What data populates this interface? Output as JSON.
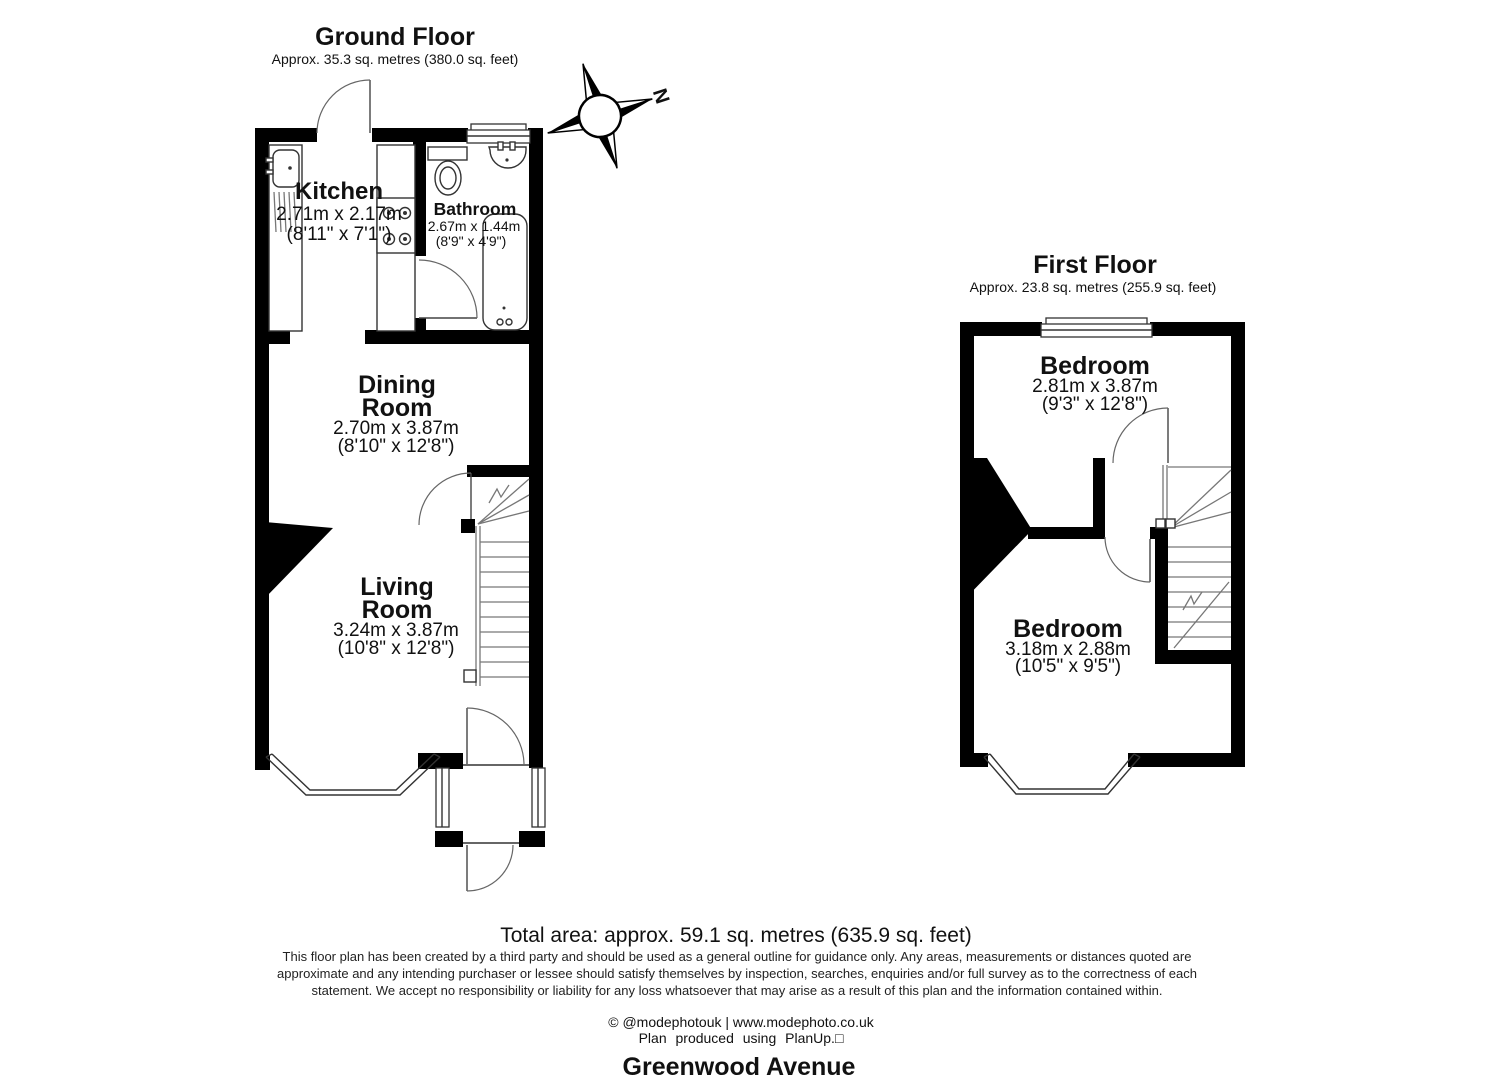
{
  "ground_floor": {
    "title": "Ground Floor",
    "subtitle": "Approx. 35.3 sq. metres (380.0 sq. feet)",
    "rooms": {
      "kitchen": {
        "name": "Kitchen",
        "metric": "2.71m x 2.17m",
        "imperial": "(8'11\" x 7'1\")"
      },
      "bathroom": {
        "name": "Bathroom",
        "metric": "2.67m x 1.44m",
        "imperial": "(8'9\" x 4'9\")"
      },
      "dining": {
        "name_line1": "Dining",
        "name_line2": "Room",
        "metric": "2.70m x 3.87m",
        "imperial": "(8'10\" x 12'8\")"
      },
      "living": {
        "name_line1": "Living",
        "name_line2": "Room",
        "metric": "3.24m x 3.87m",
        "imperial": "(10'8\" x 12'8\")"
      }
    }
  },
  "first_floor": {
    "title": "First Floor",
    "subtitle": "Approx. 23.8 sq. metres (255.9 sq. feet)",
    "rooms": {
      "bedroom1": {
        "name": "Bedroom",
        "metric": "2.81m x 3.87m",
        "imperial": "(9'3\" x 12'8\")"
      },
      "bedroom2": {
        "name": "Bedroom",
        "metric": "3.18m x 2.88m",
        "imperial": "(10'5\" x 9'5\")"
      }
    }
  },
  "compass": {
    "label": "N"
  },
  "footer": {
    "total_area": "Total area: approx. 59.1 sq. metres (635.9 sq. feet)",
    "disclaimer_line1": "This floor plan has been created by a third party and should be used as a general outline for guidance only. Any areas, measurements or distances quoted are",
    "disclaimer_line2": "approximate and any intending purchaser or lessee should satisfy themselves by inspection, searches, enquiries and/or full survey as to the correctness of each",
    "disclaimer_line3": "statement. We accept no responsibility or liability for any loss whatsoever that may arise as a result of this plan and the information contained within.",
    "credit": "© @modephotouk | www.modephoto.co.uk",
    "produced": "Plan produced using PlanUp.□",
    "address": "Greenwood Avenue"
  }
}
